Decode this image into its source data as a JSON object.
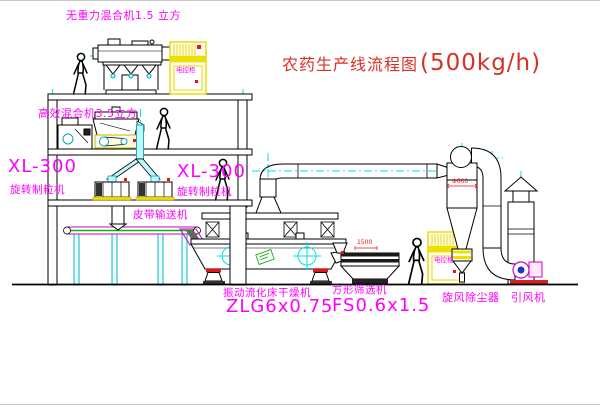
{
  "diagram": {
    "title": {
      "name": "农药生产线流程图",
      "capacity": "(500kg/h)"
    },
    "equipment": {
      "top_mixer": "无重力混合机1.5 立方",
      "floor2_mixer": "高效混合机3.5立方",
      "granulator_left": {
        "model": "XL-300",
        "name": "旋转制粒机"
      },
      "granulator_mid": {
        "model": "XL-300",
        "name": "旋转制粒机"
      },
      "belt_conveyor": "皮带输送机",
      "dryer": {
        "name": "振动流化床干燥机",
        "model": "ZLG6x0.75"
      },
      "sieve": {
        "name": "方形筛选机",
        "model": "FS0.6x1.5"
      },
      "cyclone": "旋风除尘器",
      "fan": "引风机",
      "control_cabinet": "电控柜"
    },
    "dimensions": {
      "cyclone_diameter": "Φ600",
      "sieve_length": "1500"
    },
    "colors": {
      "label": "#ff00ff",
      "title": "#d93025",
      "outline": "#000000",
      "centerline": "#00e0e8",
      "accent_yellow": "#f0e000",
      "accent_red": "#ee1111",
      "accent_green": "#00aa00"
    }
  }
}
